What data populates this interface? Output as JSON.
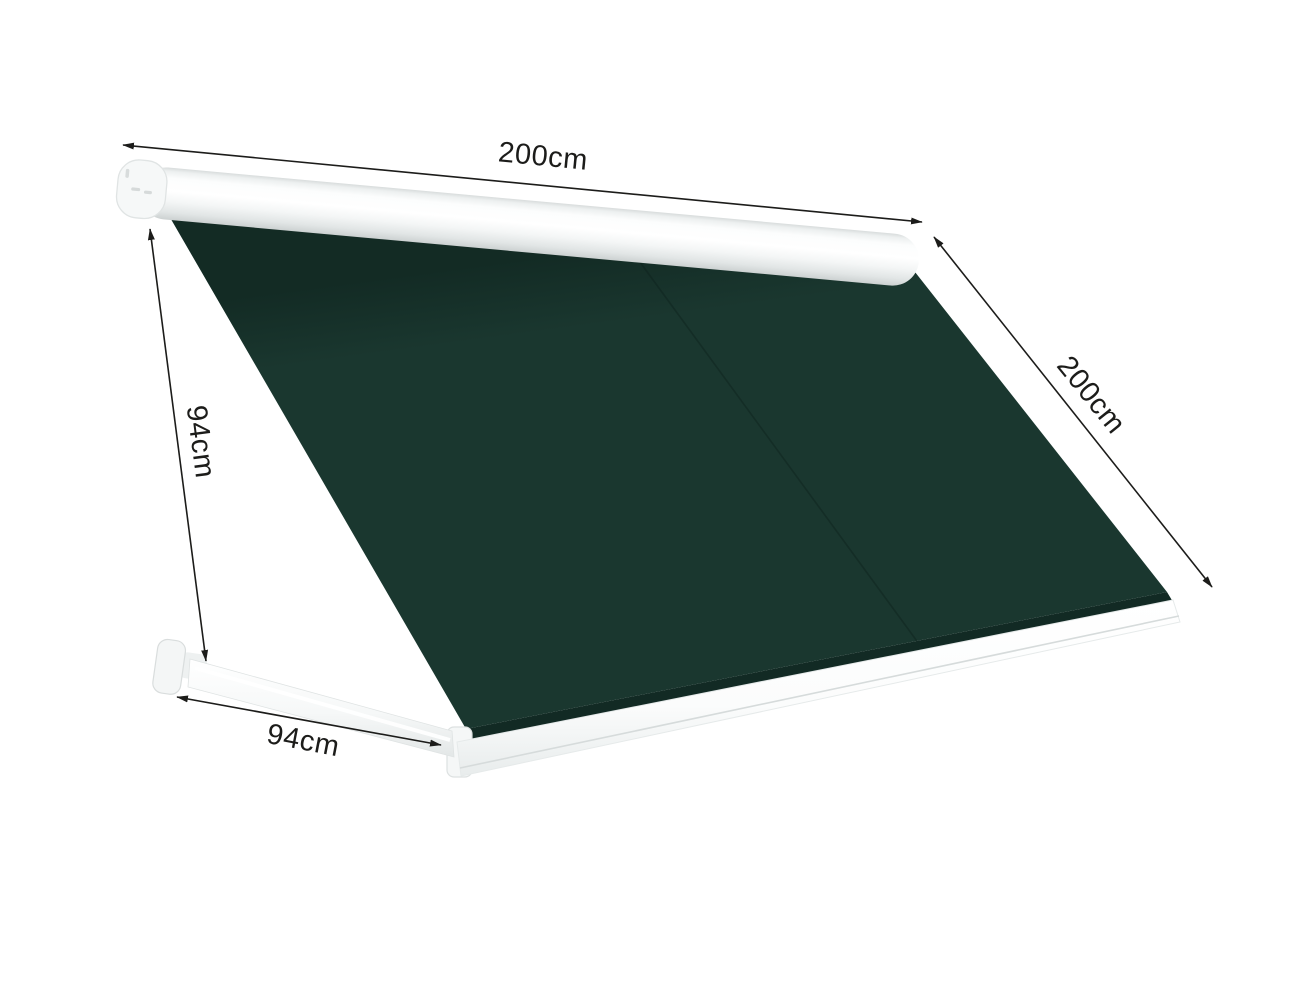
{
  "diagram": {
    "dimensions": {
      "width_top": {
        "label": "200cm"
      },
      "projection_side": {
        "label": "200cm"
      },
      "height_left": {
        "label": "94cm"
      },
      "arm_projection_bottom": {
        "label": "94cm"
      }
    },
    "colors": {
      "fabric": "#1a372f",
      "fabric_edge_band": "#122a24",
      "frame_white": "#ffffff",
      "dimension_line": "#1c1c1a",
      "background": "#ffffff"
    }
  }
}
